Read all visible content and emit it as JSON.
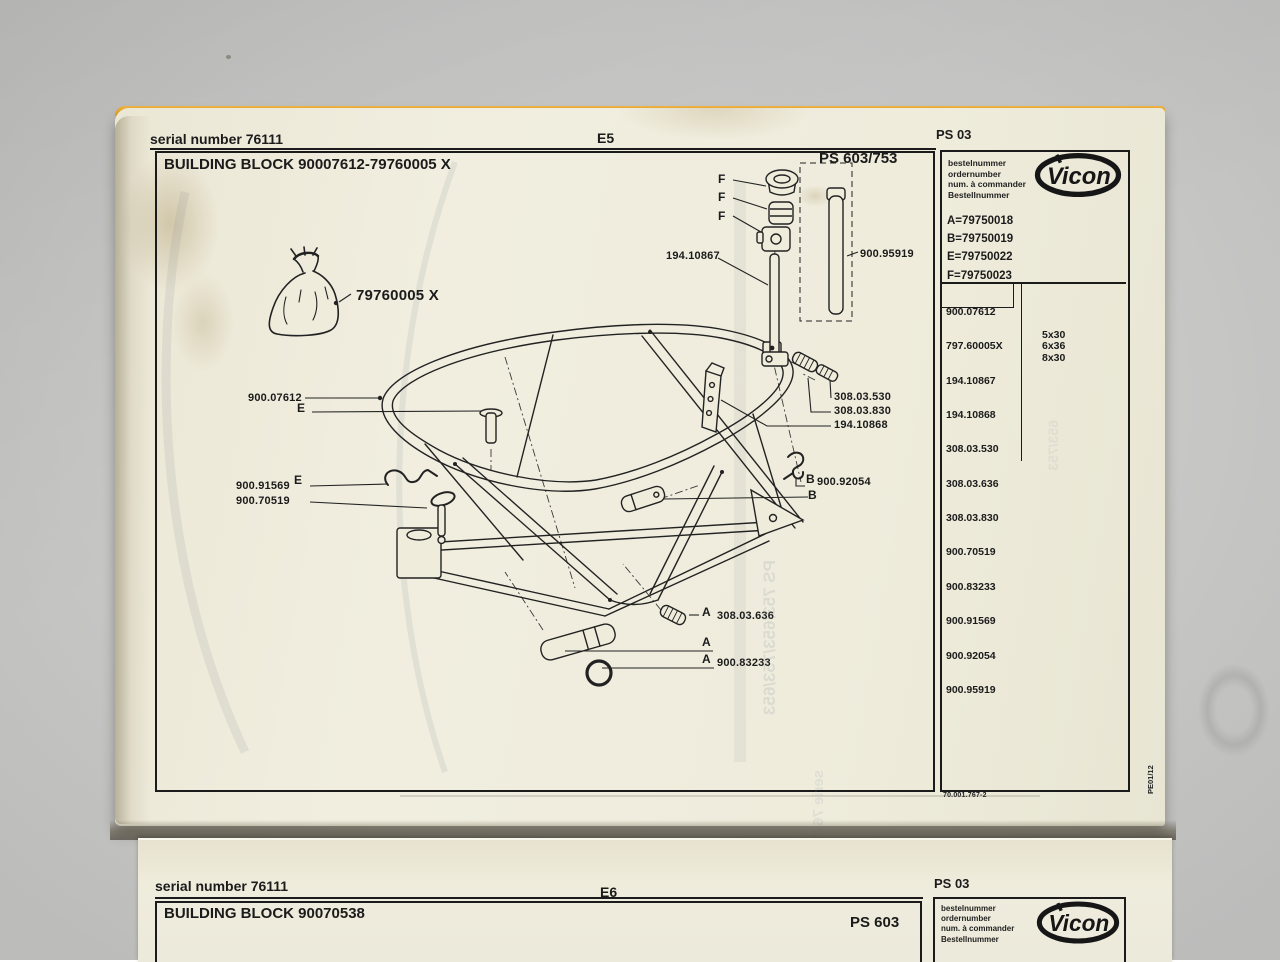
{
  "colors": {
    "backdrop": "#c7c7c6",
    "paper": "#efecdc",
    "edge_band": "#e3a22f",
    "ink": "#1b1b1b"
  },
  "page1": {
    "serial": "serial number 76111",
    "sheet": "E5",
    "title": "BUILDING BLOCK 90007612-79760005 X",
    "model": "PS 603/753",
    "panel": {
      "code": "PS 03",
      "order_labels": [
        "bestelnummer",
        "ordernumber",
        "num. à commander",
        "Bestellnummer"
      ],
      "brand": "Vicon",
      "letters": [
        "A=79750018",
        "B=79750019",
        "E=79750022",
        "F=79750023"
      ],
      "parts": [
        "900.07612",
        "797.60005X",
        "194.10867",
        "194.10868",
        "308.03.530",
        "308.03.636",
        "308.03.830",
        "900.70519",
        "900.83233",
        "900.91569",
        "900.92054",
        "900.95919"
      ],
      "sizes": [
        {
          "part": "308.03.530",
          "size": "5x30"
        },
        {
          "part": "308.03.636",
          "size": "6x36"
        },
        {
          "part": "308.03.830",
          "size": "8x30"
        }
      ],
      "doc_number": "70.001.767-2",
      "print_code": "PE01/12"
    },
    "diagram": {
      "labels": [
        {
          "text": "F"
        },
        {
          "text": "F"
        },
        {
          "text": "F"
        },
        {
          "text": "194.10867"
        },
        {
          "text": "900.95919"
        },
        {
          "text": "79760005 X"
        },
        {
          "text": "900.07612"
        },
        {
          "text": "E"
        },
        {
          "text": "900.91569"
        },
        {
          "text": "E"
        },
        {
          "text": "900.70519"
        },
        {
          "text": "308.03.530"
        },
        {
          "text": "308.03.830"
        },
        {
          "text": "194.10868"
        },
        {
          "text": "B"
        },
        {
          "text": "900.92054"
        },
        {
          "text": "B"
        },
        {
          "text": "A"
        },
        {
          "text": "308.03.636"
        },
        {
          "text": "A"
        },
        {
          "text": "A"
        },
        {
          "text": "900.83233"
        }
      ],
      "ghost": [
        "PS 753/653/753/653",
        "serie 76111",
        "653/753"
      ]
    }
  },
  "page2": {
    "serial": "serial number 76111",
    "sheet": "E6",
    "title": "BUILDING BLOCK 90070538",
    "model": "PS 603",
    "panel": {
      "code": "PS 03",
      "order_labels": [
        "bestelnummer",
        "ordernumber",
        "num. à commander",
        "Bestellnummer"
      ],
      "brand": "Vicon"
    }
  }
}
